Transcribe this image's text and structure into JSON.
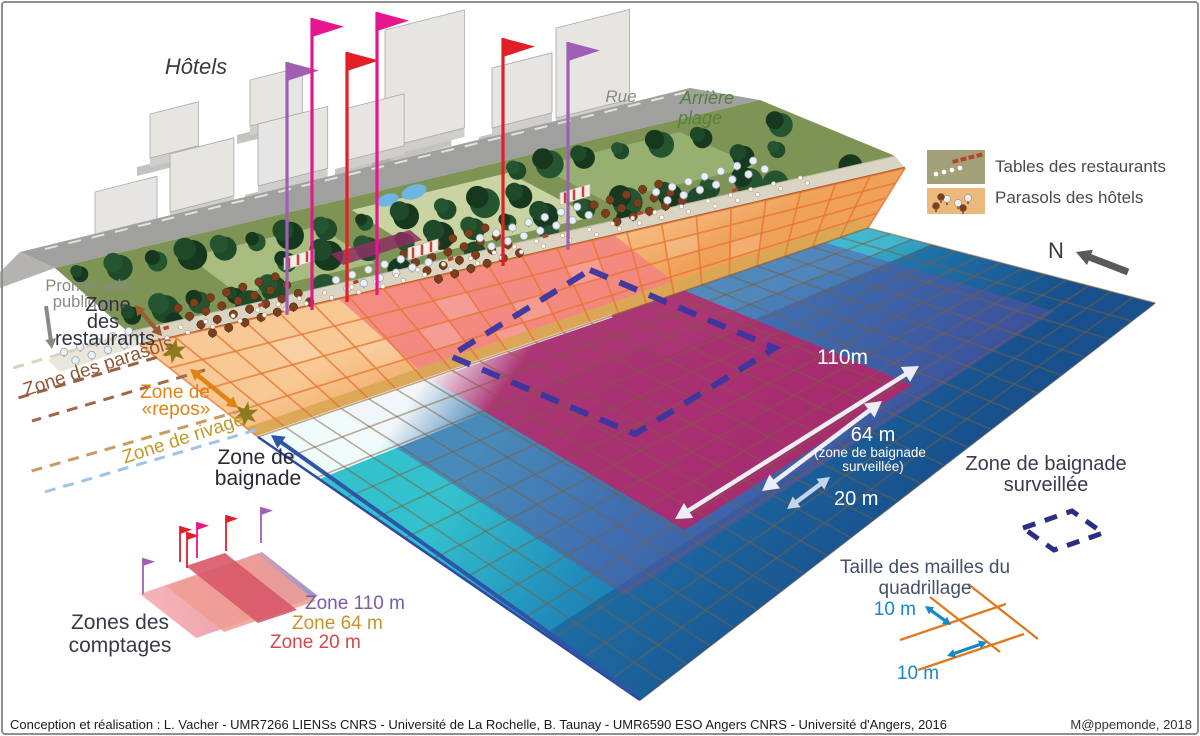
{
  "scene": {
    "hotels": "Hôtels",
    "rue": "Rue",
    "arriere_plage_1": "Arrière",
    "arriere_plage_2": "plage"
  },
  "legend": {
    "tables": "Tables des restaurants",
    "parasols": "Parasols des hôtels",
    "north": "N"
  },
  "zones": {
    "promenade_1": "Promenade",
    "promenade_2": "publique",
    "restaurants_1": "Zone",
    "restaurants_2": "des",
    "restaurants_3": "restaurants",
    "parasols": "Zone des parasols",
    "repos_1": "Zone de",
    "repos_2": "«repos»",
    "rivage": "Zone de rivage",
    "baignade_1": "Zone de",
    "baignade_2": "baignade"
  },
  "measures": {
    "d110": "110m",
    "d64": "64 m",
    "d64_note_1": "(zone de baignade",
    "d64_note_2": "surveillée)",
    "d20": "20 m"
  },
  "surveillee": {
    "line1": "Zone de baignade",
    "line2": "surveillée"
  },
  "mesh": {
    "title_1": "Taille des mailles du",
    "title_2": "quadrillage",
    "size_top": "10 m",
    "size_bottom": "10 m"
  },
  "comptages": {
    "title_1": "Zones des",
    "title_2": "comptages",
    "zone110": "Zone 110 m",
    "zone64": "Zone 64 m",
    "zone20": "Zone 20 m"
  },
  "footer": {
    "credit": "Conception et réalisation : L. Vacher - UMR7266 LIENSs CNRS - Université de La Rochelle, B. Taunay -  UMR6590 ESO Angers CNRS - Université d'Angers, 2016",
    "source": "M@ppemonde, 2018"
  },
  "colors": {
    "sand": "#F2AC66",
    "sand_light": "#F8C994",
    "sand_shore": "#D9A855",
    "beach_grid": "#E8732F",
    "pink_band_beach": "#F2837F",
    "water_teal": "#33C2CD",
    "water_mid": "#2089BA",
    "water_deep": "#174E8B",
    "water_grid": "#7D5F3C",
    "crimson_band": "#C51E60",
    "purple_band": "#5D51A5",
    "navy_dash": "#3A35A0",
    "building_face": "#E6E5E2",
    "building_side": "#CFCECB",
    "building_shadow": "#ABAAA7",
    "road": "#A0A09E",
    "park_green": "#7E9454",
    "tree_dark": "#1B4226",
    "promenade": "#DAD5C3",
    "promenade_wall": "#8B4A2A",
    "flag_purple": "#A05FB5",
    "flag_magenta": "#E8168C",
    "flag_red": "#E21E26",
    "arrow_white": "#EDEDF5",
    "arrow_blue": "#2F55A8",
    "arrow_gray": "#8A8A85",
    "arrow_brown": "#9A5B30",
    "arrow_orange": "#E08214",
    "arrow_lightblue": "#C7D3E8",
    "star_gold": "#8F7A1E",
    "label_dark": "#33333F",
    "label_gray": "#8A8A85",
    "label_brown": "#8F5A3C",
    "label_orange": "#E08214",
    "label_gold": "#C09A28",
    "label_green": "#55813B",
    "label_purple": "#7A5CA8",
    "label_red": "#D84848",
    "legend_tables_bg": "#A3A17A",
    "legend_parasols_bg": "#EBB87D",
    "mesh_orange": "#E07820",
    "mesh_blue": "#1588C8",
    "north_gray": "#5A5A5A"
  }
}
